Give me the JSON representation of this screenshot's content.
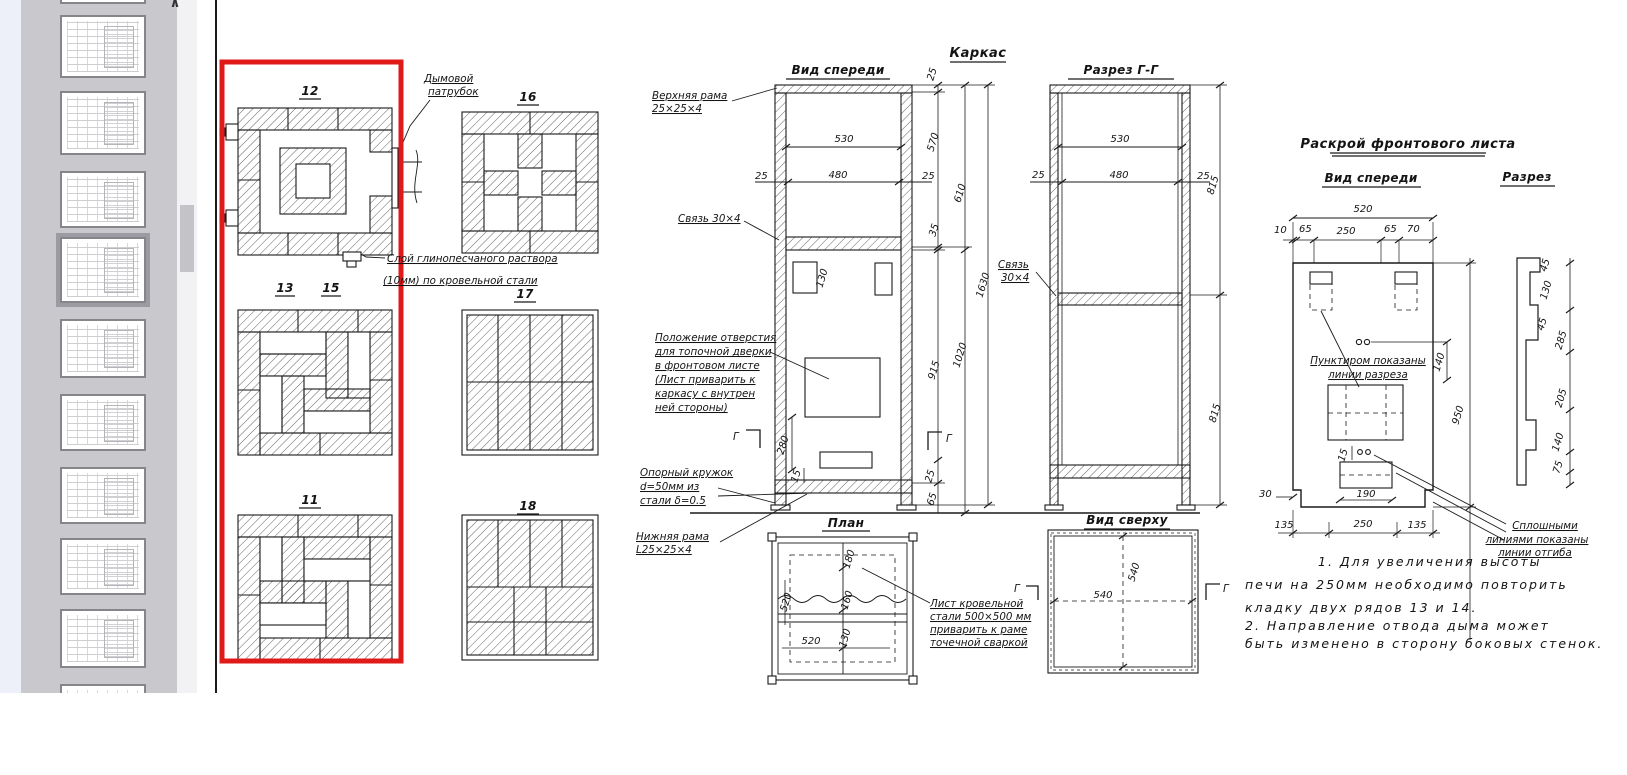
{
  "sidebar": {
    "scroll_up_icon": "∧"
  },
  "plans": {
    "p12": "12",
    "p16": "16",
    "p13": "13",
    "p15": "15",
    "p17": "17",
    "p11": "11",
    "p18": "18",
    "smoke_note": [
      "Дымовой",
      "патрубок"
    ],
    "mortar_note": [
      "Слой глинопесчаного раствора",
      "(10мм) по кровельной стали"
    ]
  },
  "frame": {
    "title": "Каркас",
    "front_title": "Вид спереди",
    "section_title": "Разрез Г-Г",
    "plan_title": "План",
    "top_title": "Вид сверху",
    "g_mark": "Г",
    "upper_frame_note": [
      "Верхняя рама",
      "25×25×4"
    ],
    "tie_note": "Связь 30×4",
    "tie_note2": [
      "Связь",
      "30×4"
    ],
    "opening_note": [
      "Положение отверстия",
      "для топочной дверки",
      "в фронтовом листе",
      "(Лист приварить к",
      "каркасу с внутрен",
      "ней стороны)"
    ],
    "support_note": [
      "Опорный кружок",
      "d=50мм из",
      "стали δ=0.5"
    ],
    "lower_frame_note": [
      "Нижняя рама",
      "L25×25×4"
    ],
    "sheet_note": [
      "Лист кровельной",
      "стали 500×500 мм",
      "приварить к раме",
      "точечной сваркой"
    ]
  },
  "cutting": {
    "title": "Раскрой фронтового листа",
    "front_title": "Вид спереди",
    "section_title": "Разрез",
    "dashed_note": [
      "Пунктиром показаны",
      "линии разреза"
    ],
    "solid_note": [
      "Сплошными",
      "линиями показаны",
      "линии отгиба"
    ]
  },
  "notes": [
    "1. Для увеличения высоты",
    "печи на 250мм необходимо повторить",
    "кладку двух рядов 13 и 14.",
    "2. Направление отвода дыма может",
    "быть изменено в сторону боковых стенок."
  ],
  "dims": {
    "d10": "10",
    "d15": "15",
    "d25": "25",
    "d30": "30",
    "d35": "35",
    "d45": "45",
    "d65": "65",
    "d70": "70",
    "d75": "75",
    "d130": "130",
    "d135": "135",
    "d140": "140",
    "d160": "160",
    "d180": "180",
    "d190": "190",
    "d205": "205",
    "d250": "250",
    "d280": "280",
    "d285": "285",
    "d480": "480",
    "d520": "520",
    "d530": "530",
    "d540": "540",
    "d570": "570",
    "d610": "610",
    "d815": "815",
    "d915": "915",
    "d950": "950",
    "d1020": "1020",
    "d1630": "1630"
  },
  "colors": {
    "highlight": "#e01919",
    "sidebar_bg": "#c9c9cd",
    "strip_bg": "#edf0f8"
  }
}
